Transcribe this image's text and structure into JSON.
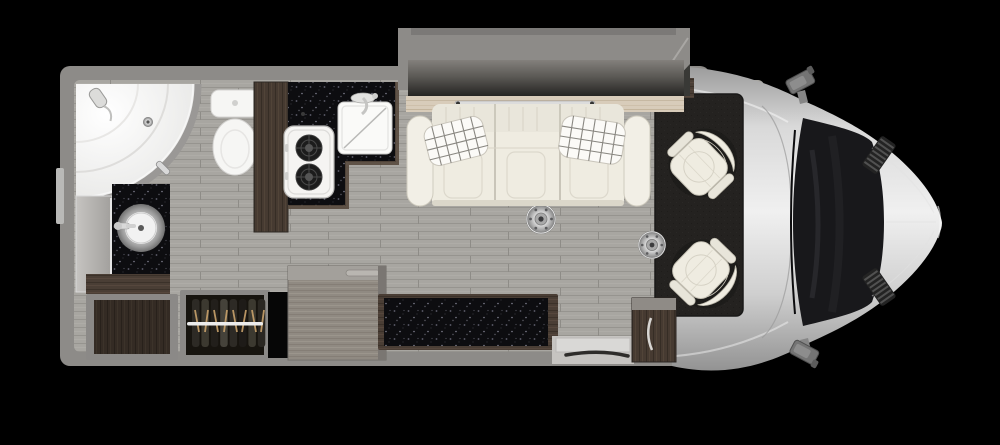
{
  "scene": {
    "kind": "rv-motorhome-floorplan-top-view",
    "background_color": "#000000",
    "palette": {
      "wall": "#8d8b88",
      "floor": "#a8a6a1",
      "countertop": "#0d0d10",
      "wood_dark": "#4a3e35",
      "wood_light": "#d8ccba",
      "upholstery_cream": "#efece1",
      "carpet": "#242220",
      "vehicle_silver": "#cfcfcf",
      "windshield": "#18181b",
      "chrome": "#d8d8d8",
      "cabinet_gray": "#908a82",
      "fixture_white": "#f6f6f4"
    },
    "areas": {
      "bathroom": [
        "corner-shower",
        "shower-door",
        "shower-head",
        "toilet",
        "vanity-mirror",
        "vanity-counter",
        "vessel-sink",
        "vanity-faucet"
      ],
      "galley": [
        "galley-side-panel",
        "galley-countertop",
        "two-burner-cooktop",
        "galley-sink",
        "galley-faucet"
      ],
      "lounge_slideout": [
        "slide-out-wall",
        "window-ledge",
        "ledge-rail",
        "sofa",
        "sofa-pillow-left",
        "sofa-pillow-right",
        "table-mount-front",
        "table-mount-rear"
      ],
      "storage": [
        "vanity-base-cabinet",
        "open-cubby",
        "wardrobe",
        "wardrobe-rod",
        "hanging-clothes",
        "refrigerator-cabinet"
      ],
      "entry": [
        "credenza",
        "entry-step",
        "entry-cabinet"
      ],
      "cab": [
        "cab-carpet",
        "cocktail-cabinet",
        "captain-chair-front",
        "captain-chair-rear"
      ],
      "vehicle": [
        "cab-shell",
        "windshield",
        "hood",
        "hood-vent-upper",
        "hood-vent-lower",
        "side-mirror-upper",
        "side-mirror-lower"
      ]
    }
  }
}
